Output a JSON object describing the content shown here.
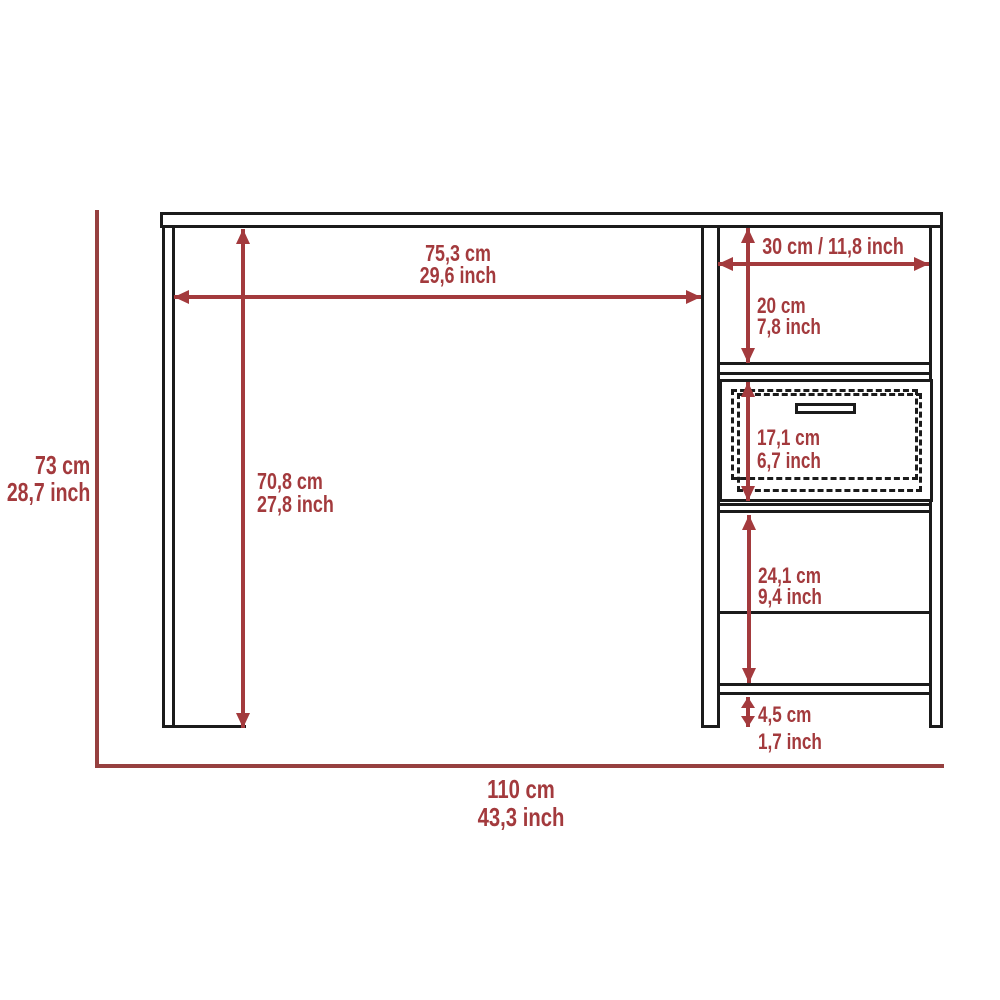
{
  "diagram_type": "desk-dimension-diagram",
  "colors": {
    "background": "#ffffff",
    "line": "#1b1b1b",
    "dimension": "#a33a3d",
    "boundary": "#96403f"
  },
  "dimensions": {
    "overall_height": {
      "cm": "73 cm",
      "inch": "28,7 inch"
    },
    "overall_width": {
      "cm": "110 cm",
      "inch": "43,3 inch"
    },
    "desktop_width": {
      "cm": "75,3 cm",
      "inch": "29,6 inch"
    },
    "leg_height": {
      "cm": "70,8 cm",
      "inch": "27,8 inch"
    },
    "side_unit_width": {
      "combined": "30 cm / 11,8 inch"
    },
    "upper_shelf_space": {
      "cm": "20 cm",
      "inch": "7,8 inch"
    },
    "drawer_height": {
      "cm": "17,1 cm",
      "inch": "6,7 inch"
    },
    "lower_shelf_space": {
      "cm": "24,1 cm",
      "inch": "9,4 inch"
    },
    "base_clearance": {
      "cm": "4,5 cm",
      "inch": "1,7 inch"
    }
  }
}
